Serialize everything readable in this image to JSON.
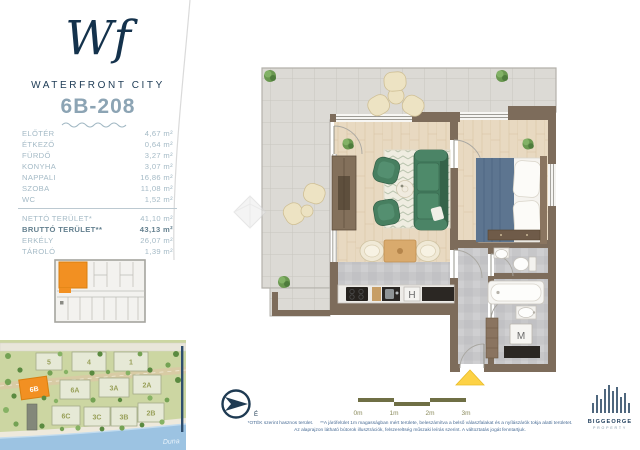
{
  "brand": {
    "monogram_w": "W",
    "monogram_f": "f",
    "name": "WATERFRONT CITY"
  },
  "unit": {
    "id": "6B-208"
  },
  "area_table": {
    "rooms": [
      {
        "label": "ELŐTÉR",
        "area": "4,67 m²"
      },
      {
        "label": "ÉTKEZŐ",
        "area": "0,64 m²"
      },
      {
        "label": "FÜRDŐ",
        "area": "3,27 m²"
      },
      {
        "label": "KONYHA",
        "area": "3,07 m²"
      },
      {
        "label": "NAPPALI",
        "area": "16,86 m²"
      },
      {
        "label": "SZOBA",
        "area": "11,08 m²"
      },
      {
        "label": "WC",
        "area": "1,52 m²"
      }
    ],
    "totals": [
      {
        "label": "NETTÓ TERÜLET*",
        "area": "41,10 m²"
      },
      {
        "label": "BRUTTÓ TERÜLET**",
        "area": "43,13 m²"
      },
      {
        "label": "ERKÉLY",
        "area": "26,07 m²"
      },
      {
        "label": "TÁROLÓ",
        "area": "1,39 m²"
      }
    ]
  },
  "plan": {
    "fridge_label": "H",
    "washer_label": "M"
  },
  "compass": {
    "north_label": "É"
  },
  "scale_bar": {
    "ticks": [
      "0m",
      "1m",
      "2m",
      "3m"
    ]
  },
  "site_map": {
    "blocks": [
      {
        "label": "5"
      },
      {
        "label": "4"
      },
      {
        "label": "1"
      },
      {
        "label": "6B"
      },
      {
        "label": "6A"
      },
      {
        "label": "3A"
      },
      {
        "label": "2A"
      },
      {
        "label": "6C"
      },
      {
        "label": "3C"
      },
      {
        "label": "3B"
      },
      {
        "label": "2B"
      }
    ],
    "river_label": "Duna",
    "highlight_color": "#f29022"
  },
  "footnotes": {
    "note1": "*OTÉK szerint hasznos terület.",
    "note2": "**A járófelület 1m magasságban mért területe, beleszámítva a belső válaszfalakat és a nyílászárók tokja alatti területet.",
    "line2": "Az alaprajzon látható bútorok illusztrációk, felszereltség műszaki leírás szerint. A változtatás jogát fenntartjuk."
  },
  "publisher": {
    "name": "BIGGEORGE",
    "division": "PROPERTY"
  },
  "colors": {
    "accent_orange": "#f29022",
    "brand_navy": "#1c3a54",
    "wall_brown": "#7d6c5b"
  }
}
